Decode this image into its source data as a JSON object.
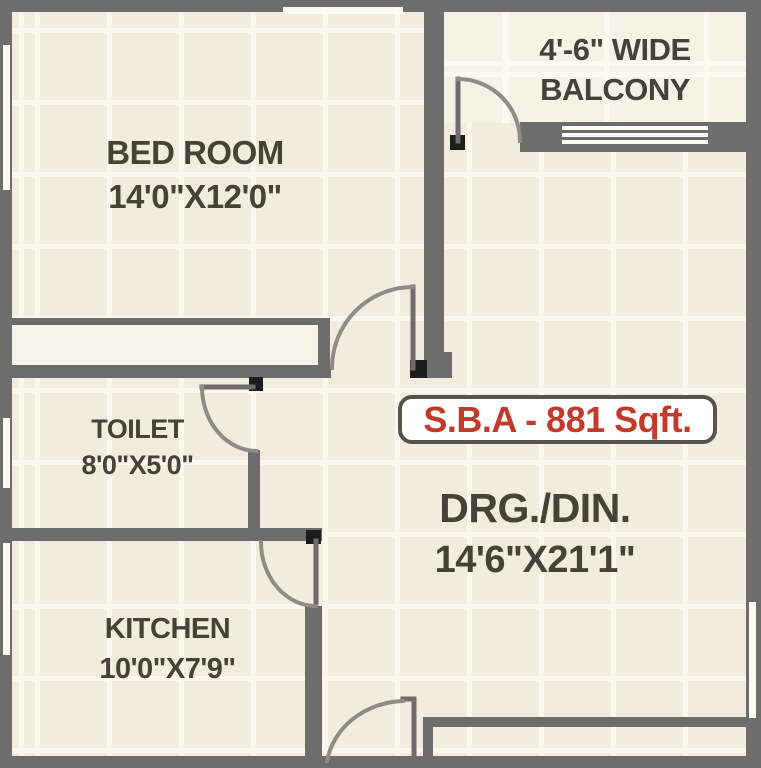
{
  "plan": {
    "badge": {
      "label": "S.B.A - 881 Sqft."
    },
    "rooms": {
      "bedroom": {
        "name": "BED ROOM",
        "dims": "14'0\"X12'0\""
      },
      "balcony": {
        "width_note": "4'-6\" WIDE",
        "name": "BALCONY"
      },
      "toilet": {
        "name": "TOILET",
        "dims": "8'0\"X5'0\""
      },
      "kitchen": {
        "name": "KITCHEN",
        "dims": "10'0\"X7'9\""
      },
      "drg_din": {
        "name": "DRG./DIN.",
        "dims": "14'6\"X21'1\""
      }
    },
    "colors": {
      "wall": "#6d6d6d",
      "floor": "#f1ecdd",
      "grout": "#faf8ee",
      "balcony_floor": "#f5f2e6",
      "label_text": "#454238",
      "badge_text": "#c23b2a",
      "badge_border": "#56534b",
      "door_arc": "#8f8c85",
      "window": "#fcfbf4"
    }
  }
}
